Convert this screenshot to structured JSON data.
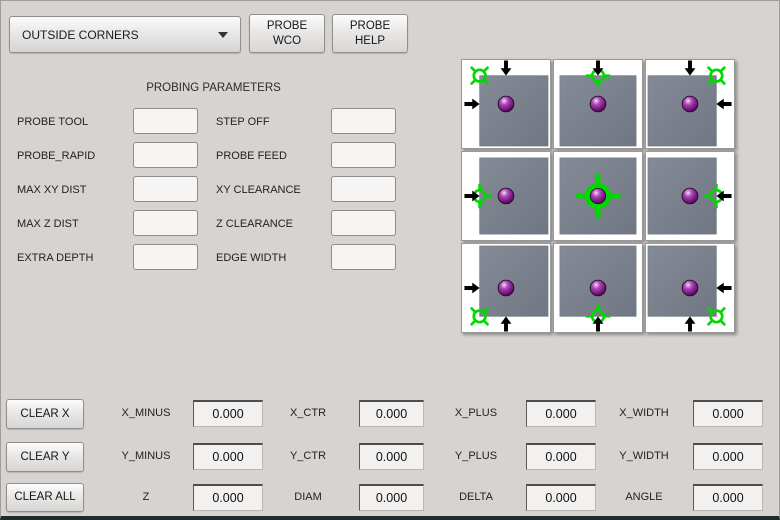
{
  "toolbar": {
    "mode_select_value": "OUTSIDE CORNERS",
    "probe_wco": {
      "line1": "PROBE",
      "line2": "WCO"
    },
    "probe_help": {
      "line1": "PROBE",
      "line2": "HELP"
    }
  },
  "parameters": {
    "title": "PROBING PARAMETERS",
    "left": [
      {
        "label": "PROBE TOOL",
        "value": ""
      },
      {
        "label": "PROBE_RAPID",
        "value": ""
      },
      {
        "label": "MAX XY DIST",
        "value": ""
      },
      {
        "label": "MAX Z DIST",
        "value": ""
      },
      {
        "label": "EXTRA DEPTH",
        "value": ""
      }
    ],
    "right": [
      {
        "label": "STEP OFF",
        "value": ""
      },
      {
        "label": "PROBE FEED",
        "value": ""
      },
      {
        "label": "XY CLEARANCE",
        "value": ""
      },
      {
        "label": "Z CLEARANCE",
        "value": ""
      },
      {
        "label": "EDGE WIDTH",
        "value": ""
      }
    ]
  },
  "probe_grid": {
    "positions": [
      "top-left-corner",
      "top-edge",
      "top-right-corner",
      "left-edge",
      "center",
      "right-edge",
      "bottom-left-corner",
      "bottom-edge",
      "bottom-right-corner"
    ],
    "icon_elements": [
      "workpiece-block",
      "probe-ball",
      "target-crosshair",
      "approach-arrow"
    ]
  },
  "results": {
    "rows": [
      {
        "button": "CLEAR X",
        "cells": [
          {
            "label": "X_MINUS",
            "value": "0.000"
          },
          {
            "label": "X_CTR",
            "value": "0.000"
          },
          {
            "label": "X_PLUS",
            "value": "0.000"
          },
          {
            "label": "X_WIDTH",
            "value": "0.000"
          }
        ]
      },
      {
        "button": "CLEAR Y",
        "cells": [
          {
            "label": "Y_MINUS",
            "value": "0.000"
          },
          {
            "label": "Y_CTR",
            "value": "0.000"
          },
          {
            "label": "Y_PLUS",
            "value": "0.000"
          },
          {
            "label": "Y_WIDTH",
            "value": "0.000"
          }
        ]
      },
      {
        "button": "CLEAR ALL",
        "cells": [
          {
            "label": "Z",
            "value": "0.000"
          },
          {
            "label": "DIAM",
            "value": "0.000"
          },
          {
            "label": "DELTA",
            "value": "0.000"
          },
          {
            "label": "ANGLE",
            "value": "0.000"
          }
        ]
      }
    ]
  },
  "colors": {
    "window_bg": "#d6d3d1",
    "target_green": "#00d800",
    "ball_purple": "#8c2796",
    "block_gray": "#7a818c",
    "arrow_black": "#000000"
  }
}
